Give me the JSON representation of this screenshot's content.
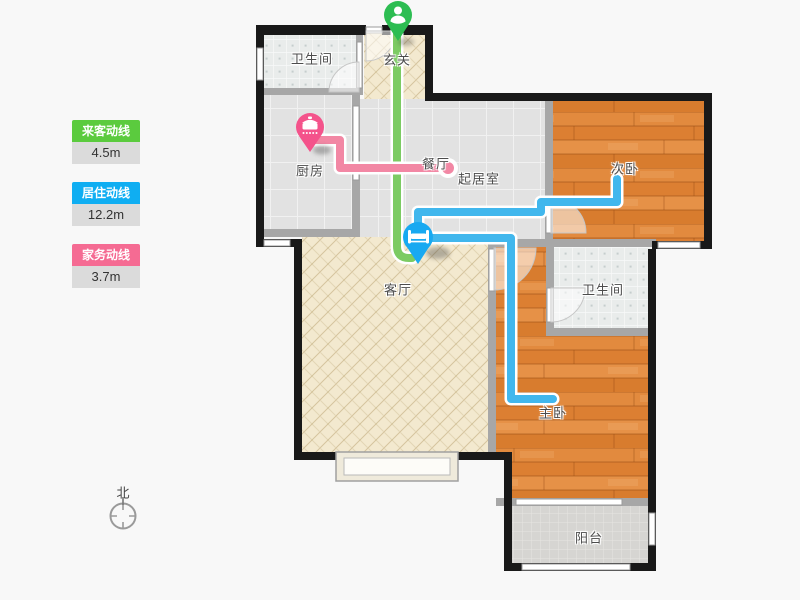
{
  "legend": {
    "items": [
      {
        "id": "guest-line",
        "label": "来客动线",
        "value": "4.5m",
        "color": "#5bcb3e"
      },
      {
        "id": "living-line",
        "label": "居住动线",
        "value": "12.2m",
        "color": "#0faef2"
      },
      {
        "id": "chore-line",
        "label": "家务动线",
        "value": "3.7m",
        "color": "#f56b93"
      }
    ]
  },
  "compass": {
    "label": "北"
  },
  "rooms": [
    {
      "id": "bathroom-top",
      "label": "卫生间",
      "floor": "tile"
    },
    {
      "id": "entry",
      "label": "玄关",
      "floor": "hatch"
    },
    {
      "id": "kitchen",
      "label": "厨房",
      "floor": "big-tile"
    },
    {
      "id": "dining",
      "label": "餐厅",
      "floor": "big-tile"
    },
    {
      "id": "living-hall",
      "label": "起居室",
      "floor": "big-tile"
    },
    {
      "id": "bedroom-second",
      "label": "次卧",
      "floor": "wood"
    },
    {
      "id": "living-room",
      "label": "客厅",
      "floor": "hatch"
    },
    {
      "id": "bathroom-right",
      "label": "卫生间",
      "floor": "tile"
    },
    {
      "id": "bedroom-master",
      "label": "主卧",
      "floor": "wood"
    },
    {
      "id": "balcony",
      "label": "阳台",
      "floor": "small-tile"
    }
  ],
  "motion_lines": [
    {
      "id": "guest-line",
      "color": "#7ccb63",
      "pin_color": "#2dbd52",
      "pin_icon": "person-icon",
      "from": "玄关",
      "to": "客厅"
    },
    {
      "id": "living-line",
      "color": "#41b7ed",
      "pin_color": "#18a9f1",
      "pin_icon": "bed-icon",
      "from": "客厅",
      "to": "次卧 / 主卧"
    },
    {
      "id": "chore-line",
      "color": "#f287a4",
      "pin_color": "#f4538b",
      "pin_icon": "pot-icon",
      "from": "厨房",
      "to": "餐厅"
    }
  ]
}
